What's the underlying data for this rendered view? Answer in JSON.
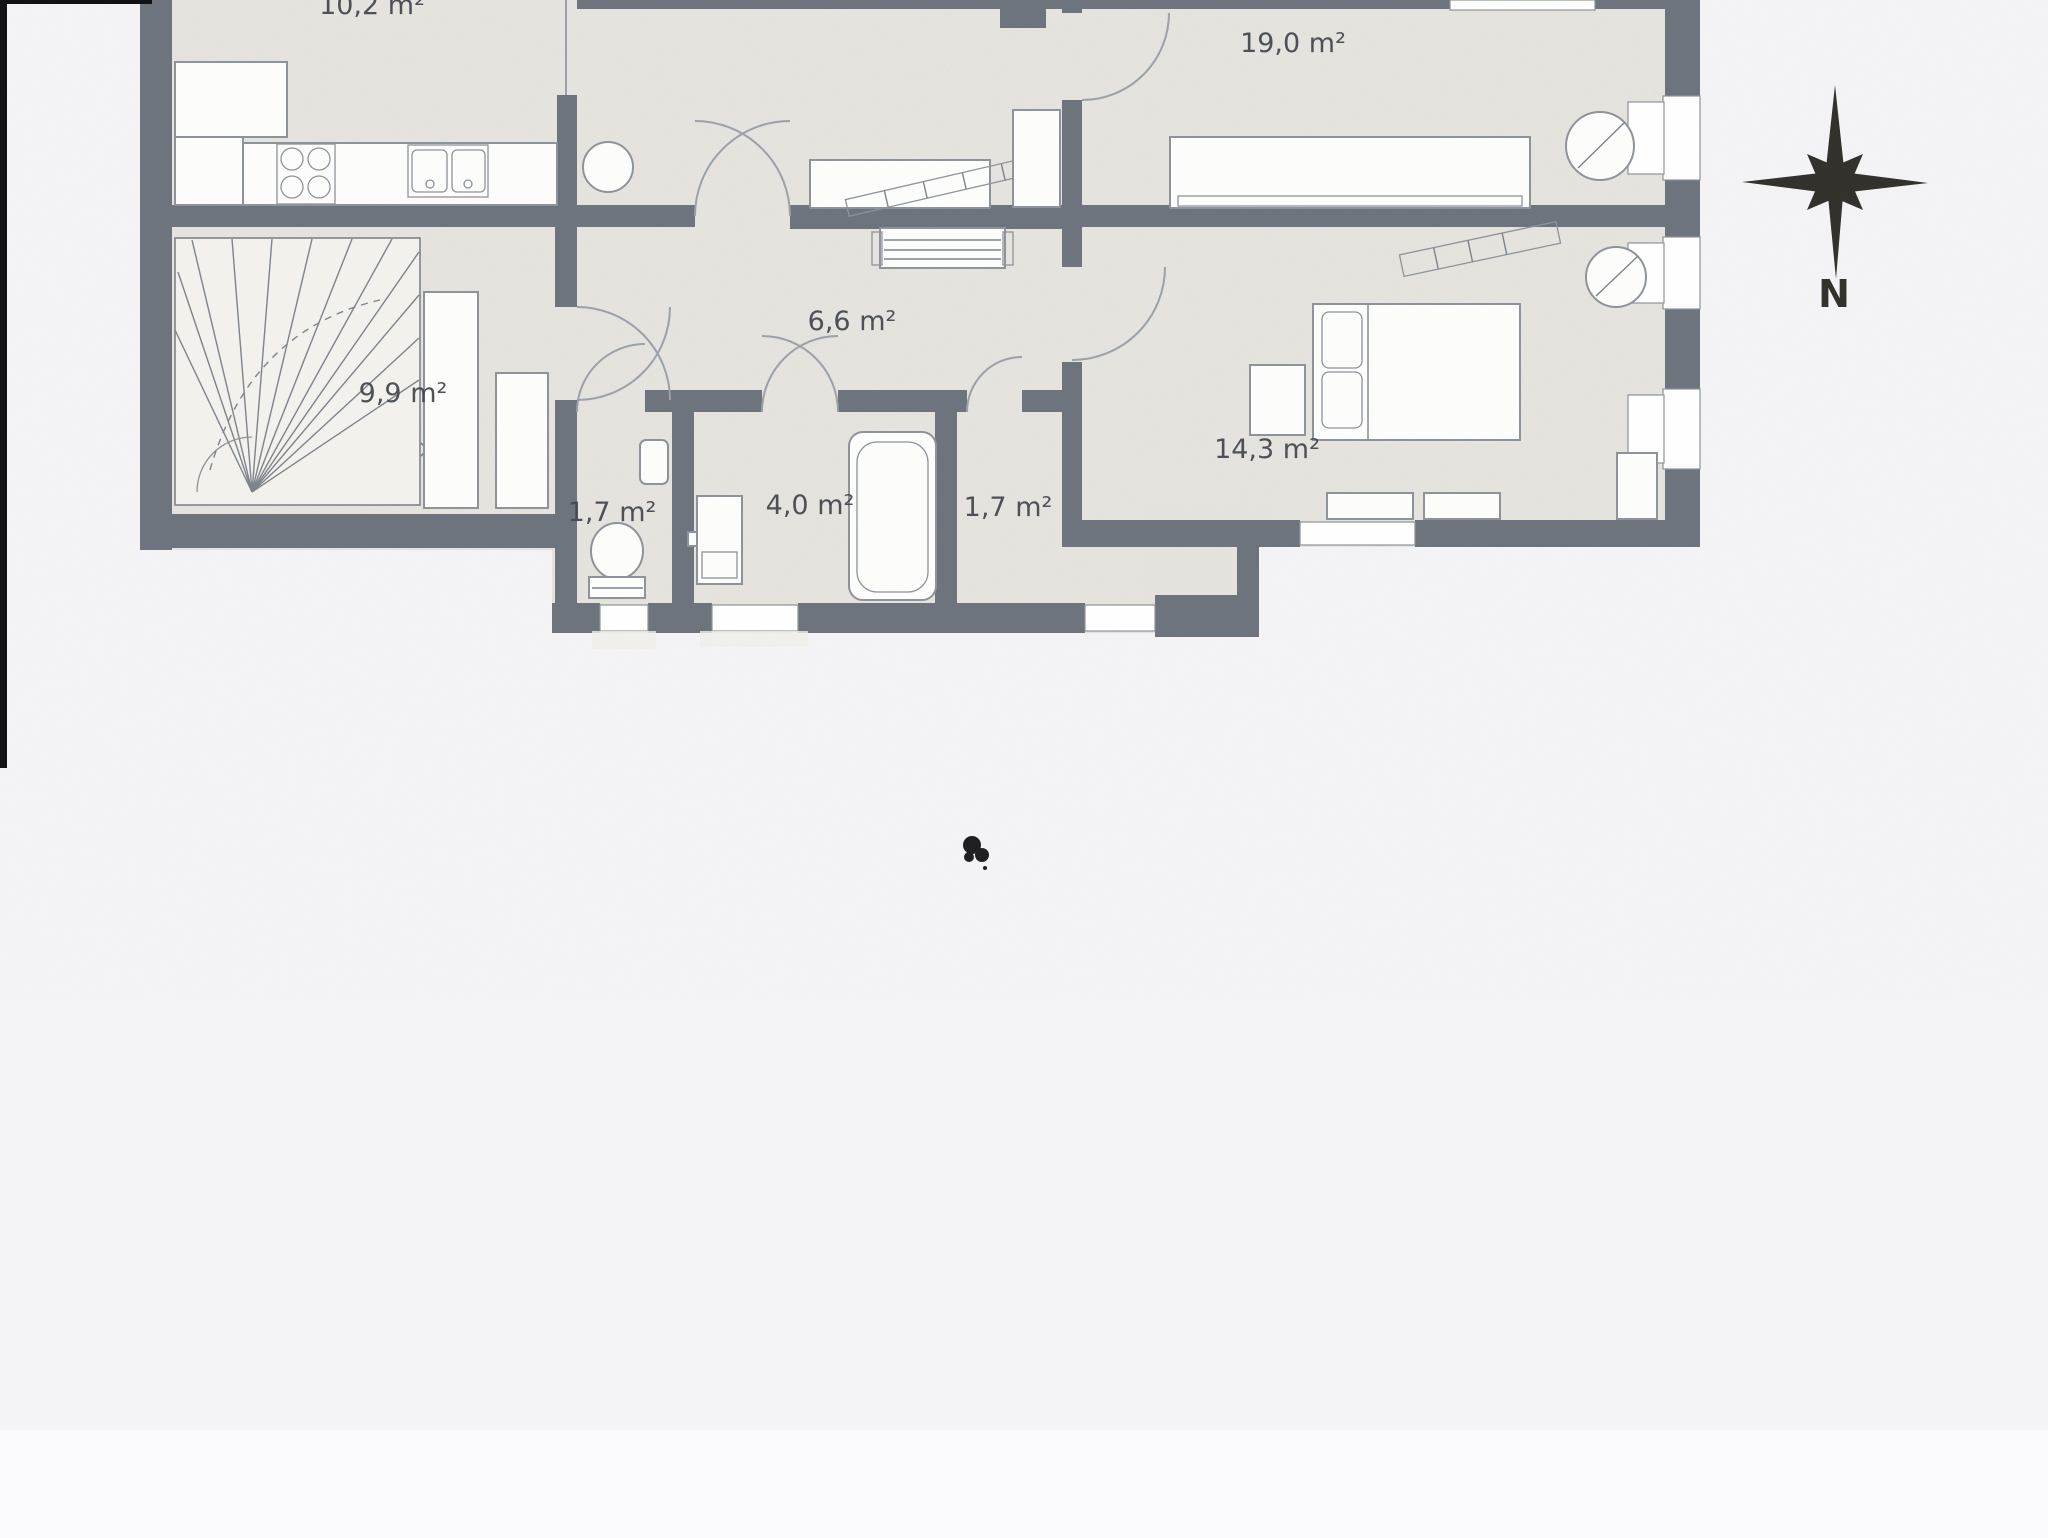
{
  "floor_plan": {
    "rooms": [
      {
        "name": "kitchen",
        "area_label": "10,2 m²",
        "clipped_at_top": true
      },
      {
        "name": "room-19",
        "area_label": "19,0 m²"
      },
      {
        "name": "hallway",
        "area_label": "6,6 m²"
      },
      {
        "name": "stair-room",
        "area_label": "9,9 m²"
      },
      {
        "name": "wc",
        "area_label": "1,7 m²"
      },
      {
        "name": "bathroom",
        "area_label": "4,0 m²"
      },
      {
        "name": "closet",
        "area_label": "1,7 m²"
      },
      {
        "name": "bedroom",
        "area_label": "14,3 m²"
      }
    ],
    "compass": {
      "north_label": "N"
    },
    "symbols": [
      "stove-symbol",
      "sink-symbol",
      "round-table-symbol",
      "sideboard-symbol",
      "radiator-symbol",
      "staircase-symbol",
      "wardrobe-symbol",
      "toilet-symbol",
      "washbasin-symbol",
      "washing-machine-symbol",
      "bathtub-symbol",
      "bed-symbol",
      "nightstand-symbol",
      "dresser-symbol",
      "desk-symbol",
      "chair-symbol",
      "door-swing-arc",
      "window-symbol",
      "compass-rose",
      "ink-blot"
    ]
  },
  "colors": {
    "paper": "#f4f4f7",
    "plan_fill": "#e8e6df",
    "wall": "#6d737c",
    "furniture_fill": "#fdfdfc",
    "furniture_stroke": "#8d939a",
    "arc": "#9aa1a8",
    "label": "#41454c",
    "compass": "#32302b",
    "scan_edge": "#111114",
    "window": "#ffffff"
  }
}
